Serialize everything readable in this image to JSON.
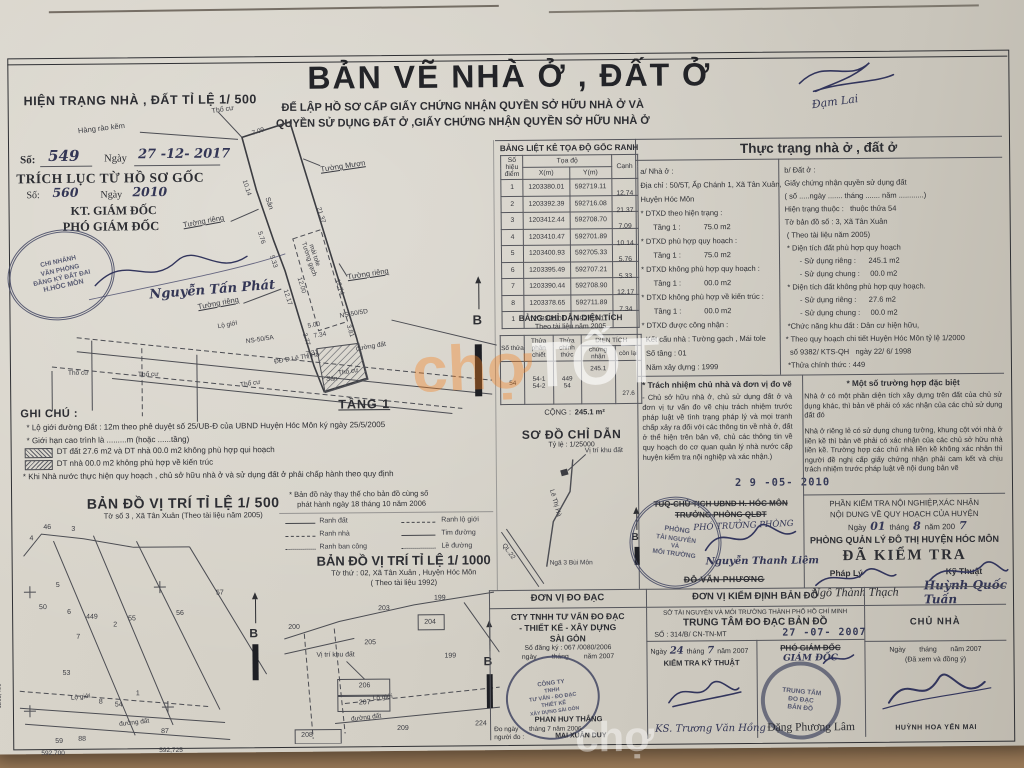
{
  "header": {
    "scale_note": "HIỆN TRẠNG NHÀ , ĐẤT TỈ LỆ 1/ 500",
    "title": "BẢN VẼ NHÀ Ở , ĐẤT Ở",
    "subtitle1": "ĐỂ LẬP HỒ SƠ CẤP GIẤY CHỨNG NHẬN QUYỀN SỞ HỮU NHÀ Ở VÀ",
    "subtitle2": "QUYỀN SỬ DỤNG ĐẤT Ở ,GIẤY CHỨNG NHẬN QUYỀN SỞ HỮU NHÀ Ở",
    "corner_sign": "Đạm Lai"
  },
  "extract": {
    "so_label": "Số:",
    "so_value": "549",
    "ngay_label": "Ngày",
    "ngay_value": "27 -12- 2017",
    "title": "TRÍCH LỤC TỪ HỒ SƠ GỐC",
    "so2_label": "Số:",
    "so2_value": "560",
    "ngay2_label": "Ngày",
    "ngay2_value": "2010",
    "role1": "KT. GIÁM ĐỐC",
    "role2": "PHÓ GIÁM ĐỐC",
    "stamp": [
      "CHI NHÁNH",
      "VĂN PHÒNG",
      "ĐĂNG KÝ ĐẤT ĐAI",
      "H.HÓC MÔN"
    ],
    "signer": "Nguyễn Tấn Phát"
  },
  "plan": {
    "floor": "TẦNG 1",
    "north": "B",
    "labels": [
      {
        "t": "Thổ cư"
      },
      {
        "t": "Hàng rào kẽm"
      },
      {
        "t": "Tường Mượn"
      },
      {
        "t": "Tường riêng"
      },
      {
        "t": "Tường riêng"
      },
      {
        "t": "Tường riêng"
      },
      {
        "t": "Sân"
      },
      {
        "t": "Tường gạch"
      },
      {
        "t": "mái tole"
      },
      {
        "t": "NS-50/5D"
      },
      {
        "t": "NS-50/5A"
      },
      {
        "t": "Lộ giới"
      },
      {
        "t": "đường đất"
      },
      {
        "t": "ĐĐ D.Lê Thị Hà"
      },
      {
        "t": "Thổ cư"
      },
      {
        "t": "Thổ cư"
      },
      {
        "t": "Thổ cư"
      },
      {
        "t": "Thổ cư"
      },
      {
        "t": "Sân"
      }
    ],
    "dims": [
      {
        "t": "7.09"
      },
      {
        "t": "10.14"
      },
      {
        "t": "21.37"
      },
      {
        "t": "5.76"
      },
      {
        "t": "5.33"
      },
      {
        "t": "12.17"
      },
      {
        "t": "12.74"
      },
      {
        "t": "12.00"
      },
      {
        "t": "5.00"
      },
      {
        "t": "3.77"
      },
      {
        "t": "7.34"
      },
      {
        "t": "3.81"
      },
      {
        "t": "7.31"
      }
    ]
  },
  "coord_table": {
    "title": "BẢNG LIỆT KÊ TỌA ĐỘ GỐC RANH",
    "h_point1": "Số hiệu",
    "h_point2": "điểm",
    "h_coord": "Tọa độ",
    "h_x": "X(m)",
    "h_y": "Y(m)",
    "h_edge": "Cạnh",
    "rows": [
      {
        "n": "1",
        "x": "1203380.01",
        "y": "592719.11",
        "c": "12.74"
      },
      {
        "n": "2",
        "x": "1203392.39",
        "y": "592716.08",
        "c": "21.37"
      },
      {
        "n": "3",
        "x": "1203412.44",
        "y": "592708.70",
        "c": "7.09"
      },
      {
        "n": "4",
        "x": "1203410.47",
        "y": "592701.89",
        "c": "10.14"
      },
      {
        "n": "5",
        "x": "1203400.93",
        "y": "592705.33",
        "c": "5.76"
      },
      {
        "n": "6",
        "x": "1203395.49",
        "y": "592707.21",
        "c": "5.33"
      },
      {
        "n": "7",
        "x": "1203390.44",
        "y": "592708.90",
        "c": "12.17"
      },
      {
        "n": "8",
        "x": "1203378.65",
        "y": "592711.89",
        "c": "7.34"
      },
      {
        "n": "1",
        "x": "1203380.01",
        "y": "592719.11",
        "c": ""
      }
    ]
  },
  "area_table": {
    "title": "BẢNG CHỈ DẪN DIỆN TÍCH",
    "subtitle": "Theo tài liệu năm 2005",
    "h1": "Số thửa",
    "h2": "Thửa phân chiết",
    "h3": "Thửa chính thức",
    "h4": "DIỆN TÍCH",
    "h4a": "chứng nhận",
    "h4b": "còn lại",
    "so_thua": "54",
    "phan_chiet_1": "54-1",
    "phan_chiet_2": "54-2",
    "chinh_thuc_1": "449",
    "chinh_thuc_2": "54",
    "chung_nhan": "245.1",
    "con_lai": "27.6",
    "sum_label": "CỘNG :",
    "sum_value": "245.1 m²"
  },
  "guide": {
    "title": "SƠ ĐỒ CHỈ DẪN",
    "scale": "Tỷ lệ : 1/25000",
    "north": "B",
    "labels": [
      {
        "t": "Vị trí khu đất"
      },
      {
        "t": "Lê Thị Hà"
      },
      {
        "t": "QL.22"
      },
      {
        "t": "Ngã 3 Bùi Môn"
      }
    ]
  },
  "status": {
    "title": "Thực trạng nhà ở , đất ở",
    "house": [
      "a/ Nhà ở :",
      "Địa chỉ : 50/5T, Ấp Chánh 1, Xã Tân Xuân,",
      "Huyện Hóc Môn",
      "* DTXD theo hiện trạng :",
      "      Tầng 1 :           75.0 m2",
      "* DTXD phù hợp quy hoạch :",
      "      Tầng 1 :           75.0 m2",
      "* DTXD không phù hợp quy hoạch :",
      "      Tầng 1 :           00.0 m2",
      "* DTXD không phù hợp về kiến trúc :",
      "      Tầng 1 :           00.0 m2",
      "* DTXD được công nhận :",
      "  Kết cấu nhà : Tường gạch , Mái tole",
      "  Số tầng : 01",
      "  Năm xây dựng : 1999"
    ],
    "land": [
      "b/ Đất ở :",
      "Giấy chứng nhận quyền sử dụng đất",
      "( số .....ngày ....... tháng ....... năm ............)",
      "Hiện trạng thuộc :   thuộc thửa 54",
      "Tờ bản đồ số : 3, Xã Tân Xuân",
      " ( Theo tài liệu năm 2005)",
      " * Diện tích đất phù hợp quy hoạch",
      "       - Sử dụng riêng :      245.1 m2",
      "       - Sử dụng chung :     00.0 m2",
      " * Diện tích đất không phù hợp quy hoạch.",
      "       - Sử dụng riêng :      27.6 m2",
      "       - Sử dụng chung :     00.0 m2",
      " *Chức năng khu đất : Dân cư hiện hữu,",
      "* Theo quy hoạch chi tiết Huyện Hóc Môn tỷ lệ 1/2000",
      "  số 9382/ KTS-QH   ngày 22/ 6/ 1998",
      " *Thửa chính thức : 449"
    ]
  },
  "resp": {
    "title": "* Trách nhiệm chủ nhà và đơn vị đo vẽ",
    "body": "- Chủ sở hữu nhà ở, chủ sử dụng đất ở và đơn vị tư vấn đo vẽ chịu trách nhiệm trước pháp luật về tình trạng pháp lý và mọi tranh chấp xảy ra đối với các thông tin về nhà ở, đất ở thể hiện trên bản vẽ, chủ các thông tin về quy hoạch do cơ quan quản lý nhà nước cấp huyện kiểm tra nội nghiệp và xác nhận.)",
    "date_stamp": "2 9 -05- 2010"
  },
  "special": {
    "title": "* Một số trường hợp đặc biệt",
    "p1": "Nhà ở có một phần diện tích xây dựng trên đất của chủ sử dụng khác, thì bản vẽ phải có xác nhận của các chủ sử dụng đất đó",
    "p2": "Nhà ở riêng lẻ có sử dụng chung tường, khung cột với nhà ở liền kề thì bản vẽ phải có xác nhận của các chủ sở hữu nhà liền kề. Trường hợp các chủ nhà liền kề không xác nhận thì người đề nghị cấp giấy chứng nhận phải cam kết và chịu trách nhiệm trước pháp luật về nội dung bản vẽ"
  },
  "approve": {
    "strike1": "TUQ-CHỦ TỊCH UBND H. HÓC MÔN",
    "strike2": "TRƯỞNG PHÒNG QLĐT",
    "hand_role": "PHÓ TRƯỞNG PHÒNG",
    "stamp": [
      "PHÒNG",
      "TÀI NGUYÊN",
      "VÀ",
      "MÔI TRƯỜNG"
    ],
    "signer": "Nguyễn Thanh Liêm",
    "strike3": "ĐỖ VĂN PHƯƠNG"
  },
  "inspect": {
    "line1": "PHẦN KIỂM TRA NỘI NGHIỆP,XÁC NHẬN",
    "line2": "NỘI DUNG VỀ QUY HOẠCH CỦA HUYỆN",
    "date_prefix": "Ngày",
    "date_day": "01",
    "date_mid": "tháng",
    "date_month": "8",
    "date_suffix": "năm 200",
    "date_year": "7",
    "office": "PHÒNG QUẢN LÝ ĐÔ THỊ HUYỆN HÓC MÔN",
    "verdict": "ĐÃ KIỂM TRA",
    "legal": "Pháp Lý",
    "tech": "Kỹ Thuật",
    "name_legal": "Ngô Thành Thạch",
    "name_tech": "Huỳnh Quốc Tuấn"
  },
  "map500": {
    "title": "BẢN ĐỒ VỊ TRÍ TỈ LỆ 1/ 500",
    "subtitle": "Tờ số 3 , Xã Tân Xuân (Theo tài liệu năm 2005)",
    "north": "B",
    "parcels": [
      {
        "t": "46"
      },
      {
        "t": "3"
      },
      {
        "t": "4"
      },
      {
        "t": "5"
      },
      {
        "t": "50"
      },
      {
        "t": "6"
      },
      {
        "t": "449"
      },
      {
        "t": "2"
      },
      {
        "t": "7"
      },
      {
        "t": "55"
      },
      {
        "t": "56"
      },
      {
        "t": "57"
      },
      {
        "t": "53"
      },
      {
        "t": "8"
      },
      {
        "t": "54"
      },
      {
        "t": "1"
      },
      {
        "t": "59"
      },
      {
        "t": "88"
      },
      {
        "t": "87"
      }
    ],
    "coords": [
      {
        "t": "592,700"
      },
      {
        "t": "592,725"
      },
      {
        "t": "1203,400"
      }
    ],
    "labels": [
      {
        "t": "Lộ giới"
      },
      {
        "t": "đường đất"
      }
    ]
  },
  "legend": {
    "replace_note1": "* Bản đồ này thay thế cho bản đồ cùng số",
    "replace_note2": "phát hành ngày 18 tháng 10 năm 2006",
    "ranh_dat": "Ranh đất",
    "ranh_nha": "Ranh nhà",
    "ranh_bc": "Ranh ban công",
    "ranh_lg": "Ranh lộ giới",
    "tim_duong": "Tim đường",
    "le_duong": "Lề đường"
  },
  "map1000": {
    "title": "BẢN ĐỒ VỊ TRÍ TỈ LỆ 1/ 1000",
    "sub1": "Tờ thứ : 02, Xã Tân Xuân , Huyện Hóc Môn",
    "sub2": "( Theo tài liệu 1992)",
    "north": "B",
    "parcels": [
      {
        "t": "199"
      },
      {
        "t": "203"
      },
      {
        "t": "204"
      },
      {
        "t": "199"
      },
      {
        "t": "205"
      },
      {
        "t": "206"
      },
      {
        "t": "207"
      },
      {
        "t": "208"
      },
      {
        "t": "209"
      },
      {
        "t": "224"
      },
      {
        "t": "200"
      }
    ],
    "labels": [
      {
        "t": "Vị trí khu đất"
      },
      {
        "t": "Lộ giới"
      },
      {
        "t": "đường đất"
      }
    ]
  },
  "survey": {
    "header": "ĐƠN VỊ ĐO ĐẠC",
    "c1": "CTY TNHH TƯ VẤN ĐO ĐẠC",
    "c2": "- THIẾT KẾ - XÂY DỰNG",
    "c3": "SÀI GÒN",
    "reg": "Số đăng ký :  067  /0080/2006",
    "reg2": "ngày        tháng        năm 2007",
    "stamp": [
      "CÔNG TY",
      "TNHH",
      "TƯ VẤN - ĐO ĐẠC",
      "THIẾT KẾ",
      "XÂY DỰNG SÀI GÒN"
    ],
    "name": "PHAN HUY THẮNG",
    "meas": "Đo ngày      tháng 7 năm 2006",
    "meas2": "người đo :",
    "measurer": "MAI XUÂN DUY"
  },
  "verify": {
    "header": "ĐƠN VỊ KIỂM ĐỊNH BẢN ĐỒ",
    "dept": "SỞ TÀI NGUYÊN VÀ MÔI TRƯỜNG THÀNH PHỐ HỒ CHÍ MINH",
    "center": "TRUNG TÂM ĐO ĐẠC BẢN ĐỒ",
    "no": "SỐ : 314/B/ CN-TN-MT",
    "date_stamp": "27 -07- 2007",
    "date_line_a": "Ngày",
    "date_line_b": "24",
    "date_line_c": "tháng",
    "date_line_d": "7",
    "date_line_e": "năm 2007",
    "check": "KIỂM TRA KỸ THUẬT",
    "engineer": "KS. Trương Văn Hồng",
    "role1": "PHÓ GIÁM ĐỐC",
    "role2": "GIÁM ĐỐC",
    "stamp": [
      "TRUNG TÂM",
      "ĐO ĐẠC",
      "BẢN ĐỒ"
    ],
    "name": "Đặng Phương Lâm"
  },
  "owner": {
    "header": "CHỦ NHÀ",
    "date": "Ngày       tháng       năm 2007",
    "note": "(Đã xem và đồng ý)",
    "name": "HUỲNH HOA YẾN MAI"
  },
  "notes": {
    "title": "GHI CHÚ :",
    "n1": "* Lộ giới đường Đất : 12m theo phê duyệt số 25/UB-Đ của UBND Huyện Hóc Môn ký ngày 25/5/2005",
    "n2": "* Giới hạn cao trình là .........m (hoặc ......tầng)",
    "n3": "DT đất 27.6 m2 và DT nhà 00.0 m2 không phù hợp qui hoạch",
    "n4": "DT nhà 00.0 m2  không phù hợp về kiến trúc",
    "n5": "* Khi Nhà nước thực hiện quy hoạch , chủ sở hữu nhà ở và sử dụng đất ở phải chấp hành theo quy định"
  },
  "watermark": {
    "w1": "chợ",
    "w2": "TỐT"
  }
}
